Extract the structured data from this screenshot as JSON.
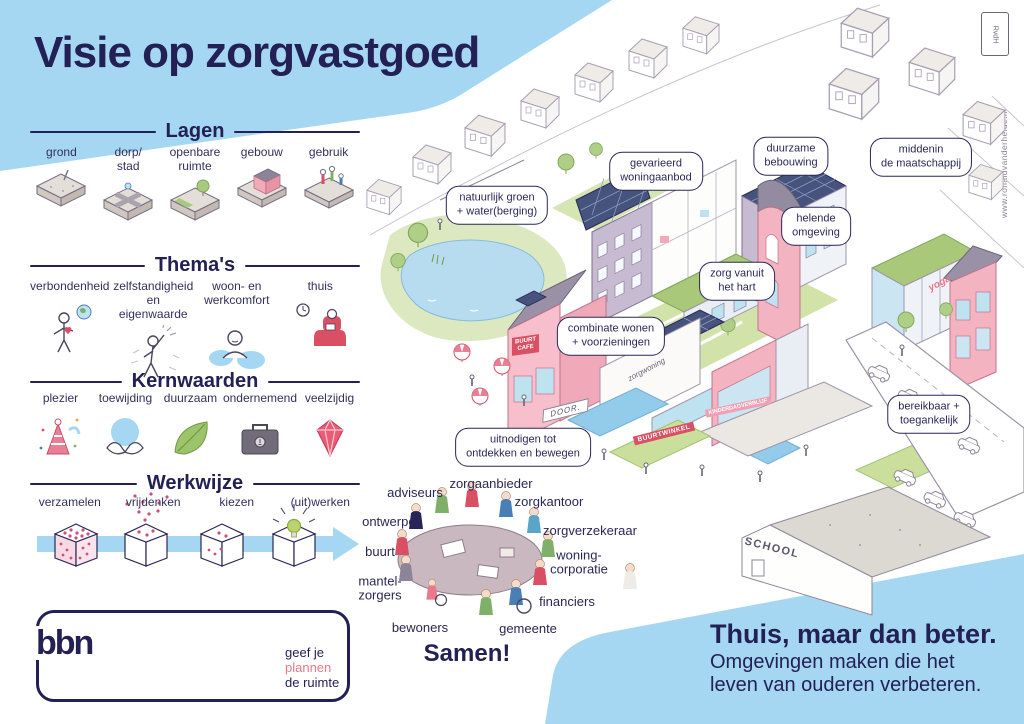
{
  "title": "Visie op zorgvastgoed",
  "credit": {
    "stamp": "RvdH",
    "website": "www.ronaldvanderheide.nl"
  },
  "sections": {
    "lagen": {
      "header": "Lagen",
      "items": [
        "grond",
        "dorp/\nstad",
        "openbare\nruimte",
        "gebouw",
        "gebruik"
      ]
    },
    "themas": {
      "header": "Thema's",
      "items": [
        "verbondenheid",
        "zelfstandigheid\nen eigenwaarde",
        "woon- en\nwerkcomfort",
        "thuis"
      ]
    },
    "kernwaarden": {
      "header": "Kernwaarden",
      "items": [
        "plezier",
        "toewijding",
        "duurzaam",
        "ondernemend",
        "veelzijdig"
      ]
    },
    "werkwijze": {
      "header": "Werkwijze",
      "items": [
        "verzamelen",
        "vrijdenken",
        "kiezen",
        "(uit)werken"
      ]
    }
  },
  "bbn": {
    "logo": "bbn",
    "tagline": [
      "geef je",
      "plannen",
      "de ruimte"
    ]
  },
  "city": {
    "labels": [
      "natuurlijk groen\n+ water(berging)",
      "gevarieerd\nwoningaanbod",
      "duurzame\nbebouwing",
      "middenin\nde maatschappij",
      "helende\nomgeving",
      "zorg vanuit\nhet hart",
      "combinate wonen\n+ voorzieningen",
      "uitnodigen tot\nontdekken en bewegen",
      "bereikbaar +\ntoegankelijk"
    ],
    "signs": {
      "cafe": "BUURT\nCAFE",
      "winkel": "BUURTWINKEL",
      "kinderdagverblijf": "KINDERDAGVERBLIJF",
      "school": "SCHOOL",
      "yoga": "yoga",
      "door": "DOOR.",
      "zorgwoning": "zorgwoning"
    }
  },
  "samen": {
    "title": "Samen!",
    "stakeholders": [
      "adviseurs",
      "zorgaanbieder",
      "zorgkantoor",
      "zorgverzekeraar",
      "woning-\ncorporatie",
      "financiers",
      "gemeente",
      "bewoners",
      "mantel-\nzorgers",
      "buurt",
      "ontwerper"
    ]
  },
  "footer": {
    "headline": "Thuis, maar dan beter.",
    "subline": "Omgevingen maken die het\nleven van ouderen verbeteren."
  }
}
